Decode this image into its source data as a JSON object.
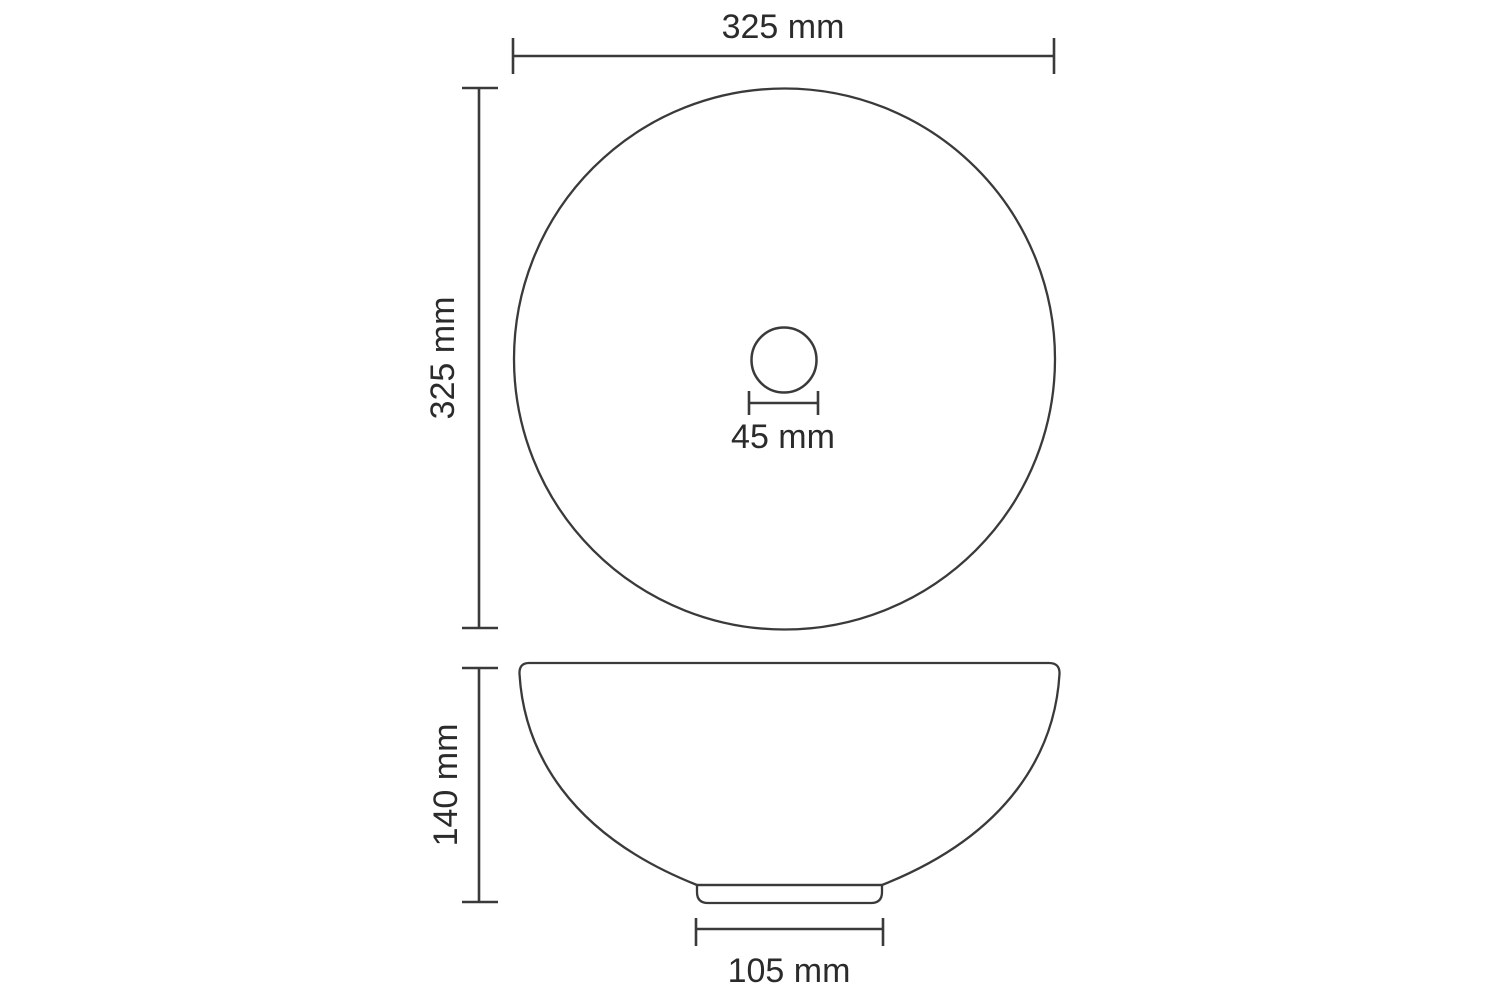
{
  "drawing": {
    "background_color": "#ffffff",
    "stroke_color": "#3a3a3a",
    "text_color": "#2b2b2b",
    "top_view": {
      "width_dim": "325 mm",
      "height_dim": "325 mm",
      "drain_dim": "45 mm"
    },
    "side_view": {
      "height_dim": "140 mm",
      "base_dim": "105 mm"
    },
    "dimensions_mm": {
      "basin_diameter": 325,
      "drain_diameter": 45,
      "basin_height": 140,
      "base_diameter": 105
    }
  }
}
